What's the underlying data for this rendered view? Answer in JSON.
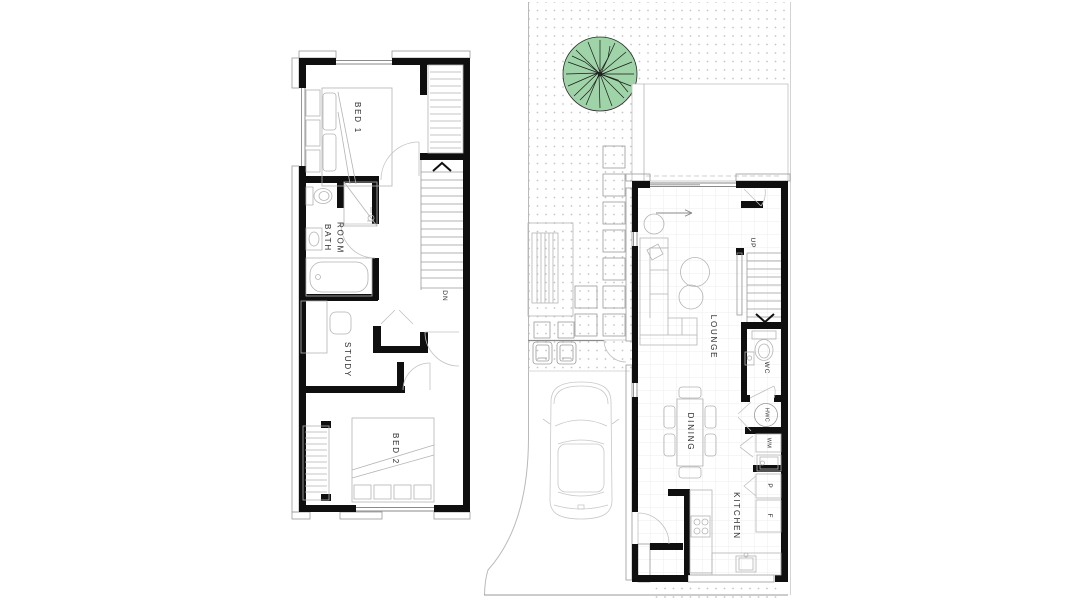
{
  "plan": {
    "upper_floor": {
      "rooms": {
        "bed1": "BED 1",
        "bathroom": "BATH\nROOM",
        "study": "STUDY",
        "bed2": "BED 2"
      },
      "stair_direction": "DN"
    },
    "ground_floor": {
      "rooms": {
        "lounge": "LOUNGE",
        "wc": "WC",
        "dining": "DINING",
        "kitchen": "KITCHEN"
      },
      "stair_direction": "UP",
      "fixtures": {
        "hot_water_cylinder": "HWC",
        "washing_machine": "WM",
        "pantry": "P",
        "fridge": "F"
      }
    },
    "colors": {
      "wall": "#0f0f0f",
      "furniture_line": "#b4b4b4",
      "hatch_line": "#9a9a9a",
      "tree_canopy": "#9fd3a8",
      "site_dots": "#c6c6c6",
      "floor_grid": "#ededed"
    }
  }
}
